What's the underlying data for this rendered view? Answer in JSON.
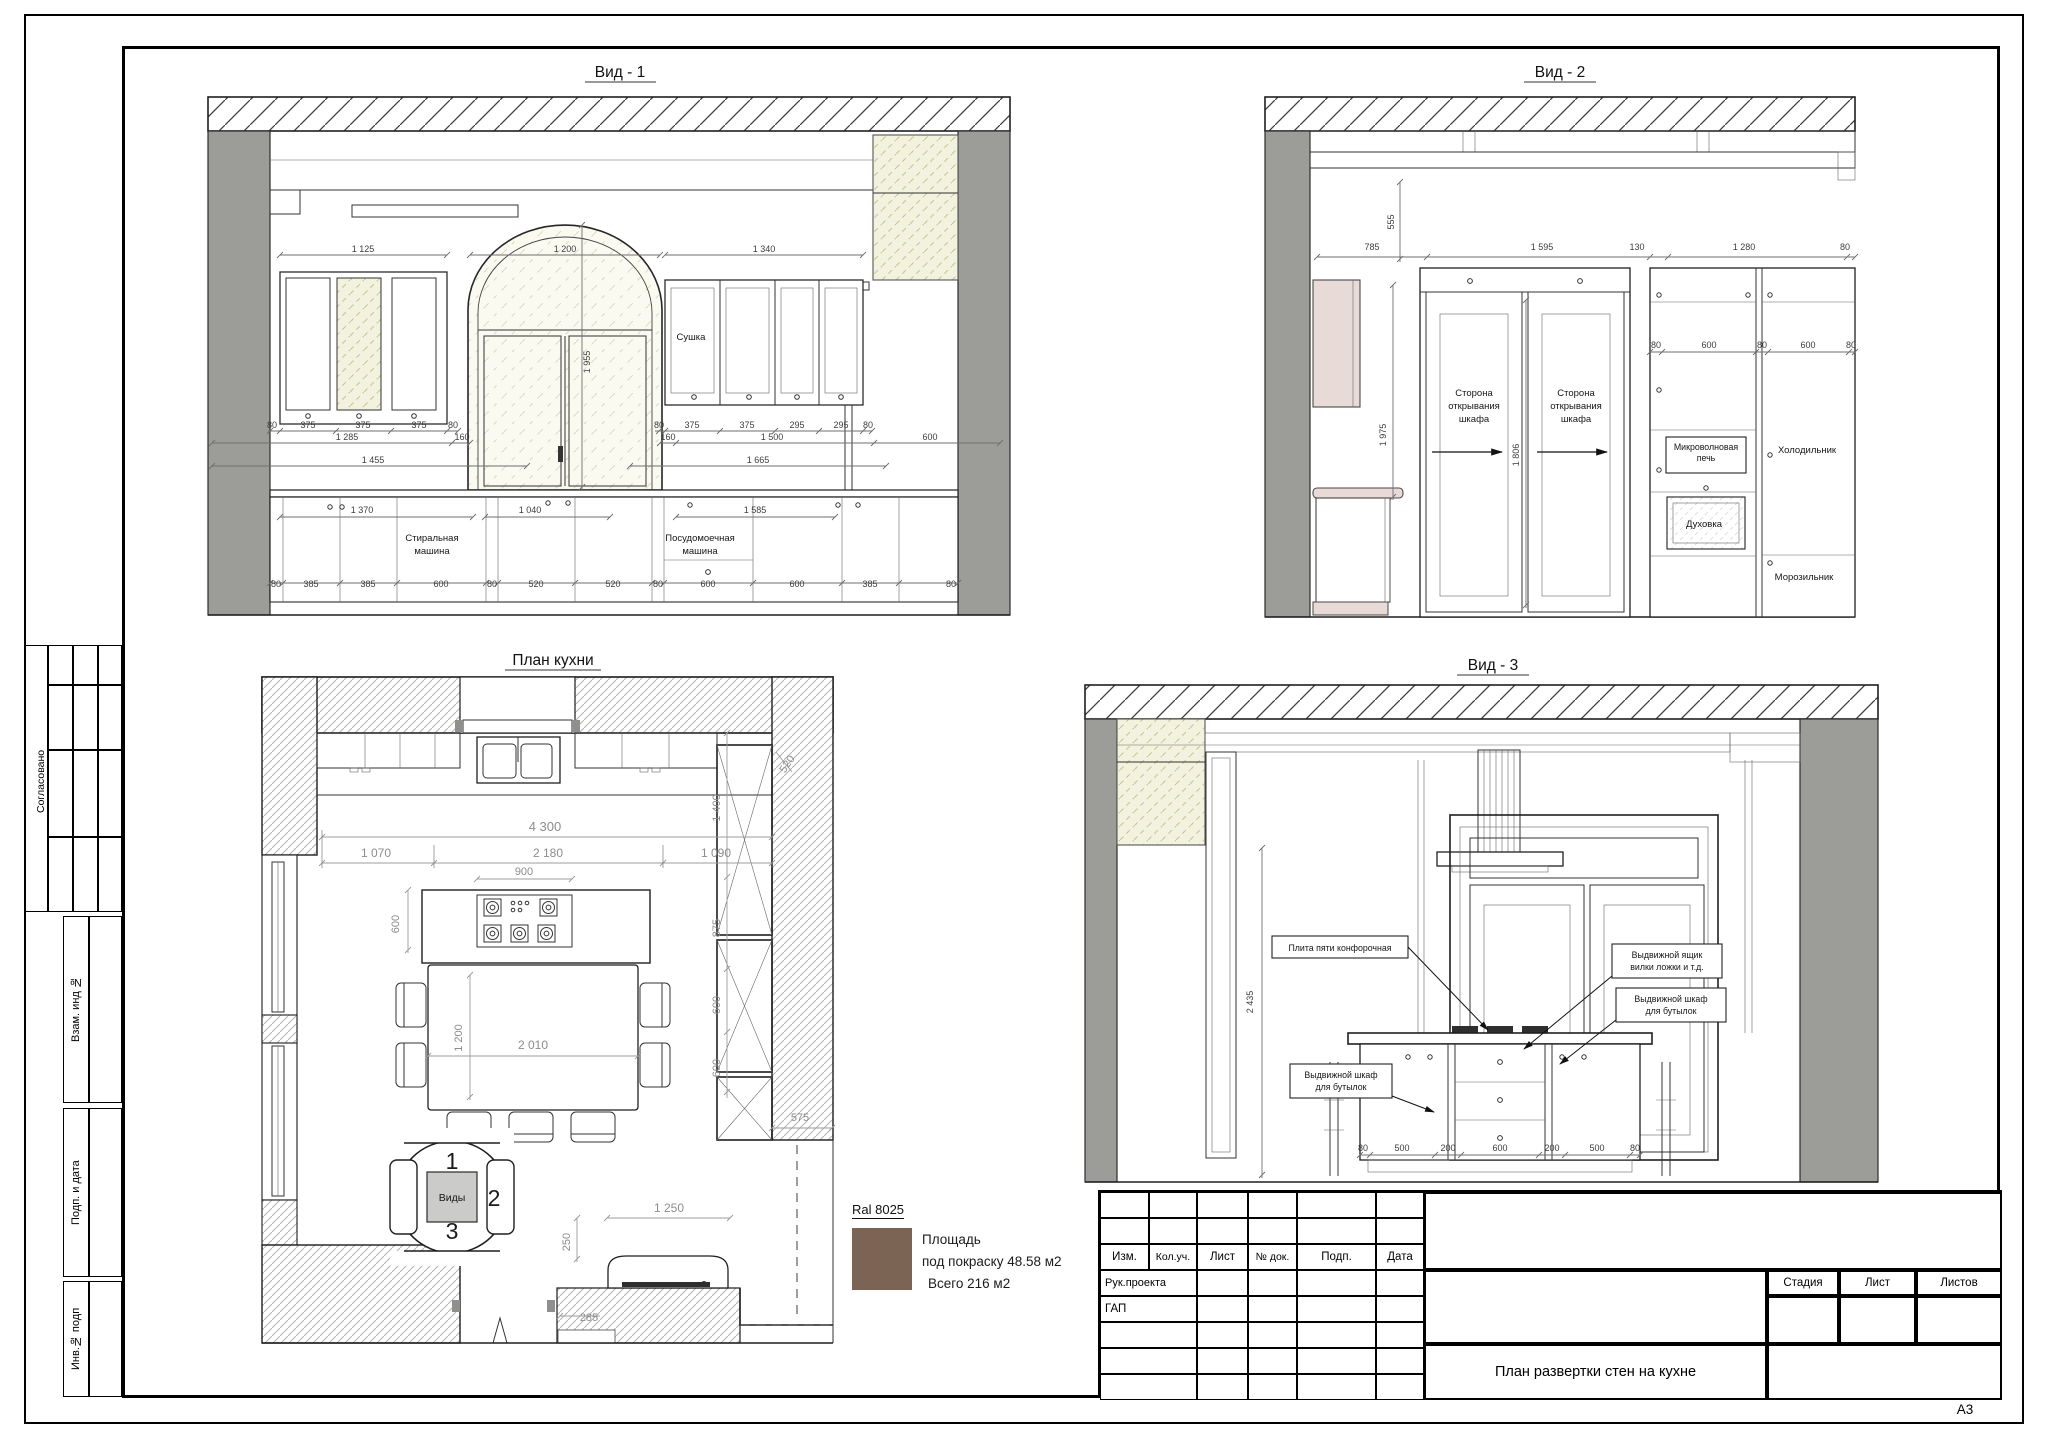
{
  "sheet": {
    "format_label": "А3",
    "doc_title": "План развертки  стен на кухне"
  },
  "stamp": {
    "headers": [
      "Изм.",
      "Кол.уч.",
      "Лист",
      "№ док.",
      "Подп.",
      "Дата"
    ],
    "left_rows": [
      "Рук.проекта",
      "ГАП"
    ],
    "right_headers": [
      "Стадия",
      "Лист",
      "Листов"
    ]
  },
  "sidebar": {
    "agreed": "Согласовано",
    "replace_inv": "Взам. инд №",
    "sign_date": "Подп. и дата",
    "inv_subpod": "Инв.№ подп"
  },
  "paint": {
    "ral_label": "Ral 8025",
    "ral_hex": "#7b6454",
    "area_line1": "Площадь",
    "area_line2": "под покраску 48.58 м2",
    "area_total": "Всего 216 м2"
  },
  "views": {
    "v1": {
      "title": "Вид - 1",
      "annotations": [
        {
          "t": "1 125",
          "x": 363,
          "y": 252,
          "c": "ed"
        },
        {
          "t": "1 200",
          "x": 565,
          "y": 252,
          "c": "ed"
        },
        {
          "t": "1 340",
          "x": 764,
          "y": 252,
          "c": "ed"
        },
        {
          "t": "1 955",
          "x": 590,
          "y": 362,
          "r": -90,
          "c": "ed"
        },
        {
          "t": "Сушка",
          "x": 691,
          "y": 340,
          "c": "lb"
        },
        {
          "t": "80",
          "x": 272,
          "y": 428,
          "c": "ed"
        },
        {
          "t": "375",
          "x": 308,
          "y": 428,
          "c": "ed"
        },
        {
          "t": "375",
          "x": 363,
          "y": 428,
          "c": "ed"
        },
        {
          "t": "375",
          "x": 419,
          "y": 428,
          "c": "ed"
        },
        {
          "t": "80",
          "x": 453,
          "y": 428,
          "c": "ed"
        },
        {
          "t": "80",
          "x": 659,
          "y": 428,
          "c": "ed"
        },
        {
          "t": "375",
          "x": 692,
          "y": 428,
          "c": "ed"
        },
        {
          "t": "375",
          "x": 747,
          "y": 428,
          "c": "ed"
        },
        {
          "t": "295",
          "x": 797,
          "y": 428,
          "c": "ed"
        },
        {
          "t": "295",
          "x": 841,
          "y": 428,
          "c": "ed"
        },
        {
          "t": "80",
          "x": 868,
          "y": 428,
          "c": "ed"
        },
        {
          "t": "1 285",
          "x": 347,
          "y": 440,
          "c": "ed"
        },
        {
          "t": "160",
          "x": 462,
          "y": 440,
          "c": "ed"
        },
        {
          "t": "160",
          "x": 668,
          "y": 440,
          "c": "ed"
        },
        {
          "t": "1 500",
          "x": 772,
          "y": 440,
          "c": "ed"
        },
        {
          "t": "600",
          "x": 930,
          "y": 440,
          "c": "ed"
        },
        {
          "t": "1 455",
          "x": 373,
          "y": 463,
          "c": "ed"
        },
        {
          "t": "1 665",
          "x": 758,
          "y": 463,
          "c": "ed"
        },
        {
          "t": "1 370",
          "x": 362,
          "y": 513,
          "c": "ed"
        },
        {
          "t": "1 040",
          "x": 530,
          "y": 513,
          "c": "ed"
        },
        {
          "t": "1 585",
          "x": 755,
          "y": 513,
          "c": "ed"
        },
        {
          "t": "Стиральная\nмашина",
          "x": 432,
          "y": 541,
          "c": "lb",
          "lh": 13
        },
        {
          "t": "Посудомоечная\nмашина",
          "x": 700,
          "y": 541,
          "c": "lb",
          "lh": 13
        },
        {
          "t": "80",
          "x": 276,
          "y": 587,
          "c": "ed"
        },
        {
          "t": "385",
          "x": 311,
          "y": 587,
          "c": "ed"
        },
        {
          "t": "385",
          "x": 368,
          "y": 587,
          "c": "ed"
        },
        {
          "t": "600",
          "x": 441,
          "y": 587,
          "c": "ed"
        },
        {
          "t": "80",
          "x": 492,
          "y": 587,
          "c": "ed"
        },
        {
          "t": "520",
          "x": 536,
          "y": 587,
          "c": "ed"
        },
        {
          "t": "520",
          "x": 613,
          "y": 587,
          "c": "ed"
        },
        {
          "t": "80",
          "x": 658,
          "y": 587,
          "c": "ed"
        },
        {
          "t": "600",
          "x": 708,
          "y": 587,
          "c": "ed"
        },
        {
          "t": "600",
          "x": 797,
          "y": 587,
          "c": "ed"
        },
        {
          "t": "385",
          "x": 870,
          "y": 587,
          "c": "ed"
        },
        {
          "t": "80",
          "x": 951,
          "y": 587,
          "c": "ed"
        }
      ]
    },
    "v2": {
      "title": "Вид - 2",
      "annotations": [
        {
          "t": "785",
          "x": 1372,
          "y": 250,
          "c": "ed"
        },
        {
          "t": "555",
          "x": 1394,
          "y": 222,
          "r": -90,
          "c": "ed"
        },
        {
          "t": "1 595",
          "x": 1542,
          "y": 250,
          "c": "ed"
        },
        {
          "t": "130",
          "x": 1637,
          "y": 250,
          "c": "ed"
        },
        {
          "t": "1 280",
          "x": 1744,
          "y": 250,
          "c": "ed"
        },
        {
          "t": "80",
          "x": 1845,
          "y": 250,
          "c": "ed"
        },
        {
          "t": "1 975",
          "x": 1386,
          "y": 435,
          "r": -90,
          "c": "ed"
        },
        {
          "t": "1 806",
          "x": 1519,
          "y": 455,
          "r": -90,
          "c": "ed"
        },
        {
          "t": "Сторона\nоткрывания\nшкафа",
          "x": 1474,
          "y": 396,
          "c": "lb",
          "lh": 13
        },
        {
          "t": "Сторона\nоткрывания\nшкафа",
          "x": 1576,
          "y": 396,
          "c": "lb",
          "lh": 13
        },
        {
          "t": "80",
          "x": 1656,
          "y": 348,
          "c": "ed"
        },
        {
          "t": "600",
          "x": 1709,
          "y": 348,
          "c": "ed"
        },
        {
          "t": "80",
          "x": 1762,
          "y": 348,
          "c": "ed"
        },
        {
          "t": "600",
          "x": 1808,
          "y": 348,
          "c": "ed"
        },
        {
          "t": "80",
          "x": 1851,
          "y": 348,
          "c": "ed"
        },
        {
          "t": "Микроволновая\nпечь",
          "x": 1706,
          "y": 450,
          "c": "lbs",
          "lh": 11
        },
        {
          "t": "Духовка",
          "x": 1704,
          "y": 527,
          "c": "lb"
        },
        {
          "t": "Холодильник",
          "x": 1807,
          "y": 453,
          "c": "lb"
        },
        {
          "t": "Морозильник",
          "x": 1804,
          "y": 580,
          "c": "lb"
        }
      ]
    },
    "plan": {
      "title": "План кухни",
      "annotations": [
        {
          "t": "4 300",
          "x": 545,
          "y": 831,
          "c": "pd",
          "s": 13
        },
        {
          "t": "1 070",
          "x": 376,
          "y": 857,
          "c": "pd",
          "s": 12
        },
        {
          "t": "2 180",
          "x": 548,
          "y": 857,
          "c": "pd",
          "s": 12
        },
        {
          "t": "1 090",
          "x": 716,
          "y": 857,
          "c": "pd",
          "s": 12
        },
        {
          "t": "900",
          "x": 524,
          "y": 875,
          "c": "pd"
        },
        {
          "t": "600",
          "x": 399,
          "y": 924,
          "r": -90,
          "c": "pd"
        },
        {
          "t": "520",
          "x": 790,
          "y": 766,
          "r": -56,
          "c": "pd"
        },
        {
          "t": "1 400",
          "x": 720,
          "y": 808,
          "r": -90,
          "c": "pd"
        },
        {
          "t": "875",
          "x": 720,
          "y": 928,
          "r": -90,
          "c": "pd"
        },
        {
          "t": "600",
          "x": 720,
          "y": 1005,
          "r": -90,
          "c": "pd"
        },
        {
          "t": "600",
          "x": 720,
          "y": 1068,
          "r": -90,
          "c": "pd"
        },
        {
          "t": "575",
          "x": 800,
          "y": 1121,
          "c": "pd"
        },
        {
          "t": "1 200",
          "x": 462,
          "y": 1038,
          "r": -90,
          "c": "pd"
        },
        {
          "t": "2 010",
          "x": 533,
          "y": 1049,
          "c": "pd",
          "s": 12
        },
        {
          "t": "1 250",
          "x": 669,
          "y": 1212,
          "c": "pd",
          "s": 12
        },
        {
          "t": "250",
          "x": 570,
          "y": 1242,
          "r": -90,
          "c": "pd"
        },
        {
          "t": "285",
          "x": 589,
          "y": 1321,
          "c": "pd"
        },
        {
          "t": "1",
          "x": 452,
          "y": 1169,
          "c": "bg"
        },
        {
          "t": "2",
          "x": 494,
          "y": 1206,
          "c": "bg"
        },
        {
          "t": "3",
          "x": 452,
          "y": 1239,
          "c": "bg"
        },
        {
          "t": "Виды",
          "x": 452,
          "y": 1201,
          "c": "lb",
          "s": 10.5
        }
      ]
    },
    "v3": {
      "title": "Вид - 3",
      "annotations": [
        {
          "t": "2 435",
          "x": 1253,
          "y": 1002,
          "r": -90,
          "c": "ed"
        },
        {
          "t": "Плита пяти конфорочная",
          "x": 1340,
          "y": 951,
          "c": "lbs"
        },
        {
          "t": "Выдвижной ящик\nвилки ложки и т.д.",
          "x": 1667,
          "y": 958,
          "c": "lbs",
          "lh": 12
        },
        {
          "t": "Выдвижной шкаф\nдля бутылок",
          "x": 1341,
          "y": 1078,
          "c": "lbs",
          "lh": 12
        },
        {
          "t": "Выдвижной шкаф\nдля бутылок",
          "x": 1671,
          "y": 1002,
          "c": "lbs",
          "lh": 12
        },
        {
          "t": "80",
          "x": 1363,
          "y": 1151,
          "c": "ed"
        },
        {
          "t": "500",
          "x": 1402,
          "y": 1151,
          "c": "ed"
        },
        {
          "t": "200",
          "x": 1448,
          "y": 1151,
          "c": "ed"
        },
        {
          "t": "600",
          "x": 1500,
          "y": 1151,
          "c": "ed"
        },
        {
          "t": "200",
          "x": 1552,
          "y": 1151,
          "c": "ed"
        },
        {
          "t": "500",
          "x": 1597,
          "y": 1151,
          "c": "ed"
        },
        {
          "t": "80",
          "x": 1635,
          "y": 1151,
          "c": "ed"
        }
      ]
    }
  }
}
